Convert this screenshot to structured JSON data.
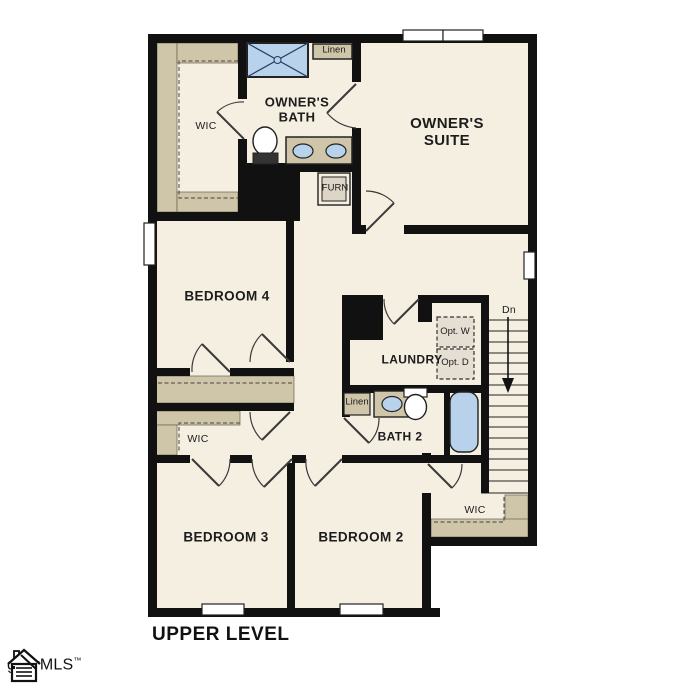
{
  "plan": {
    "level_label": "UPPER LEVEL",
    "rooms": {
      "owners_suite": "OWNER'S SUITE",
      "owners_bath": "OWNER'S BATH",
      "owner_wic": "WIC",
      "bedroom4": "BEDROOM 4",
      "bedroom3": "BEDROOM 3",
      "bedroom2": "BEDROOM 2",
      "laundry": "LAUNDRY",
      "bath2": "BATH 2",
      "wic_bedroom3": "WIC",
      "wic_bedroom2": "WIC"
    },
    "closets": {
      "linen_owners_bath": "Linen",
      "linen_bath2": "Linen"
    },
    "equipment": {
      "furnace": "FURN",
      "optional_washer": "Opt. W",
      "optional_dryer": "Opt. D"
    },
    "stairs": {
      "direction_label": "Dn"
    },
    "colors": {
      "wall": "#111111",
      "floor": "#f5efe1",
      "shelving_tan": "#cfc5a9",
      "fixture_blue": "#b8d2ec",
      "appliance_gray": "#e4ded3"
    }
  },
  "watermark": {
    "mls_name": "ggarMLS",
    "trademark_symbol": "™"
  }
}
